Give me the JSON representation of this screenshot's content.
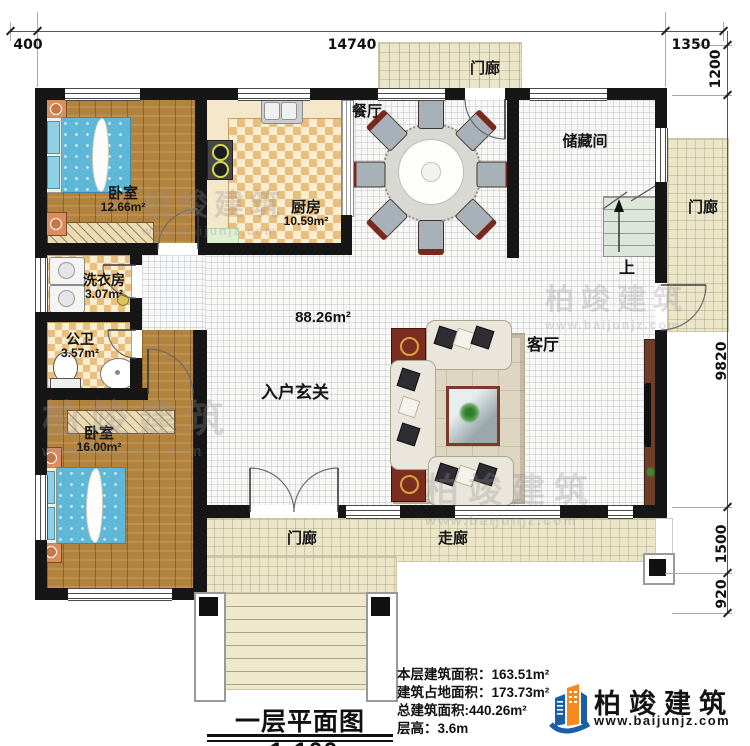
{
  "dims": {
    "top": [
      "400",
      "14740",
      "1350"
    ],
    "right": [
      "1200",
      "9820",
      "1500",
      "920"
    ]
  },
  "rooms": {
    "bedroom_top": {
      "name": "卧室",
      "area": "12.66m²"
    },
    "kitchen": {
      "name": "厨房",
      "area": "10.59m²"
    },
    "dining": {
      "name": "餐厅"
    },
    "storage": {
      "name": "储藏间"
    },
    "laundry": {
      "name": "洗衣房",
      "area": "3.07m²"
    },
    "bathroom": {
      "name": "公卫",
      "area": "3.57m²"
    },
    "bedroom_bottom": {
      "name": "卧室",
      "area": "16.00m²"
    },
    "foyer": {
      "name": "入户玄关"
    },
    "living": {
      "name": "客厅"
    },
    "hall_area": "88.26m²",
    "porch": "门廊",
    "corridor": "走廊",
    "stairs_up": "上"
  },
  "footer": {
    "stats": [
      {
        "label": "本层建筑面积：",
        "value": "163.51m²"
      },
      {
        "label": "建筑占地面积：",
        "value": "173.73m²"
      },
      {
        "label": "总建筑面积:",
        "value": "440.26m²"
      },
      {
        "label": "层高：",
        "value": "3.6m"
      }
    ],
    "plan_title": "一层平面图",
    "plan_scale": "1:100"
  },
  "brand": {
    "name": "柏竣建筑",
    "url": "www.baijunjz.com"
  },
  "watermark": {
    "name": "柏竣建筑",
    "url": "www.baijunjz.com"
  },
  "colors": {
    "wall": "#161616",
    "wood": "#b2823f",
    "tile": "#f8f8f6",
    "porch": "#ebe6c9",
    "checker": "#eabe7d",
    "bed": "#5fb8d8",
    "brand_blue": "#1b5ea6",
    "brand_orange": "#f28a1e"
  }
}
